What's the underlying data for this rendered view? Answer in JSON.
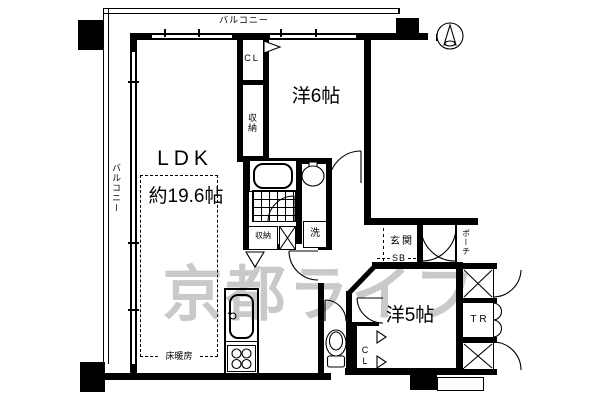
{
  "labels": {
    "balcony_top": "バルコニー",
    "balcony_left": "バルコニー",
    "ldk": "LDK",
    "ldk_size": "約19.6帖",
    "floor_heating": "床暖房",
    "western6": "洋6帖",
    "western5": "洋5帖",
    "closet_top": "CL",
    "closet_w5": "CL",
    "storage_hall": "収納",
    "storage_bath": "収納",
    "laundry": "洗",
    "entrance": "玄関",
    "shoebox": "SB",
    "porch": "ポーチ",
    "trunk_room": "TR",
    "watermark": "京都ライフ"
  },
  "colors": {
    "line": "#000000",
    "background": "#ffffff",
    "watermark": "#c9c9c9"
  },
  "icons": {
    "compass": "north-arrow"
  }
}
